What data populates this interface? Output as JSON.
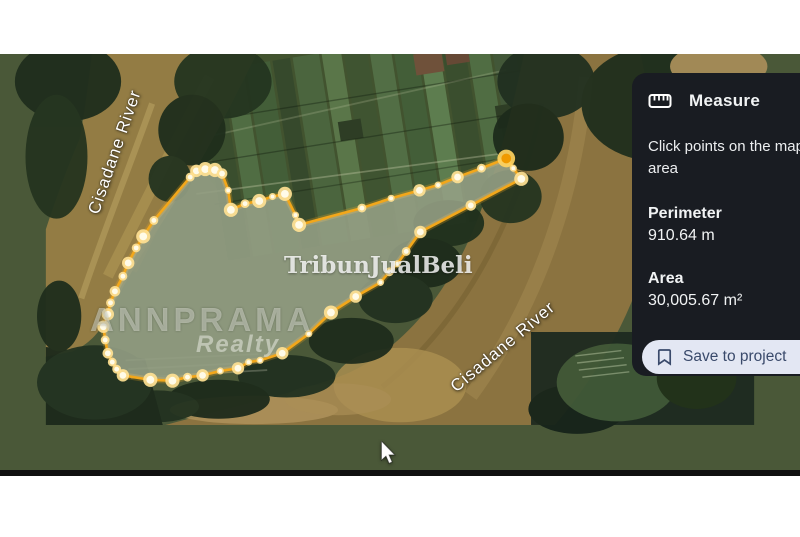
{
  "map": {
    "labels": [
      {
        "text": "Cisadane River"
      },
      {
        "text": "Cisadane River"
      }
    ],
    "watermarks": {
      "brand": "ANNPRAMA",
      "brand_sub": "Realty",
      "listing": "TribunJualBeli"
    }
  },
  "measurement": {
    "stroke_color": "#f2a71b",
    "fill_overlay": "rgba(255,255,255,0.30)",
    "meadow_color": "#5e6e46",
    "dot_halo": "#ffe193",
    "dot_core": "#fffbe8",
    "active_halo": "#ffd35e",
    "active_core": "#f09a00",
    "points": [
      {
        "x": 163,
        "y": 193,
        "r": 5
      },
      {
        "x": 170,
        "y": 186,
        "r": 7
      },
      {
        "x": 180,
        "y": 184,
        "r": 8
      },
      {
        "x": 191,
        "y": 185,
        "r": 8
      },
      {
        "x": 199,
        "y": 189,
        "r": 6
      },
      {
        "x": 206,
        "y": 208,
        "r": 4
      },
      {
        "x": 209,
        "y": 230,
        "r": 8
      },
      {
        "x": 225,
        "y": 223,
        "r": 5
      },
      {
        "x": 241,
        "y": 220,
        "r": 8
      },
      {
        "x": 256,
        "y": 215,
        "r": 4
      },
      {
        "x": 270,
        "y": 212,
        "r": 8
      },
      {
        "x": 282,
        "y": 236,
        "r": 4
      },
      {
        "x": 286,
        "y": 247,
        "r": 8
      },
      {
        "x": 357,
        "y": 228,
        "r": 5
      },
      {
        "x": 390,
        "y": 217,
        "r": 4
      },
      {
        "x": 422,
        "y": 208,
        "r": 7
      },
      {
        "x": 443,
        "y": 202,
        "r": 4
      },
      {
        "x": 465,
        "y": 193,
        "r": 7
      },
      {
        "x": 492,
        "y": 183,
        "r": 5
      },
      {
        "x": 520,
        "y": 172,
        "r": 10,
        "active": true
      },
      {
        "x": 528,
        "y": 183,
        "r": 4
      },
      {
        "x": 537,
        "y": 195,
        "r": 8
      },
      {
        "x": 480,
        "y": 225,
        "r": 6
      },
      {
        "x": 423,
        "y": 255,
        "r": 7
      },
      {
        "x": 407,
        "y": 277,
        "r": 5
      },
      {
        "x": 397,
        "y": 291,
        "r": 4
      },
      {
        "x": 388,
        "y": 300,
        "r": 5
      },
      {
        "x": 378,
        "y": 312,
        "r": 4
      },
      {
        "x": 350,
        "y": 328,
        "r": 7
      },
      {
        "x": 322,
        "y": 346,
        "r": 8
      },
      {
        "x": 297,
        "y": 370,
        "r": 4
      },
      {
        "x": 267,
        "y": 392,
        "r": 7
      },
      {
        "x": 242,
        "y": 400,
        "r": 4
      },
      {
        "x": 229,
        "y": 402,
        "r": 4
      },
      {
        "x": 217,
        "y": 409,
        "r": 7
      },
      {
        "x": 197,
        "y": 412,
        "r": 4
      },
      {
        "x": 177,
        "y": 417,
        "r": 7
      },
      {
        "x": 160,
        "y": 419,
        "r": 5
      },
      {
        "x": 143,
        "y": 423,
        "r": 8
      },
      {
        "x": 118,
        "y": 422,
        "r": 8
      },
      {
        "x": 87,
        "y": 417,
        "r": 7
      },
      {
        "x": 80,
        "y": 410,
        "r": 5
      },
      {
        "x": 75,
        "y": 402,
        "r": 5
      },
      {
        "x": 70,
        "y": 392,
        "r": 6
      },
      {
        "x": 67,
        "y": 377,
        "r": 5
      },
      {
        "x": 65,
        "y": 362,
        "r": 7
      },
      {
        "x": 70,
        "y": 348,
        "r": 7
      },
      {
        "x": 73,
        "y": 335,
        "r": 5
      },
      {
        "x": 78,
        "y": 322,
        "r": 6
      },
      {
        "x": 87,
        "y": 305,
        "r": 5
      },
      {
        "x": 93,
        "y": 290,
        "r": 7
      },
      {
        "x": 102,
        "y": 273,
        "r": 5
      },
      {
        "x": 110,
        "y": 260,
        "r": 8
      },
      {
        "x": 122,
        "y": 242,
        "r": 5
      }
    ]
  },
  "panel": {
    "bg": "#191c22",
    "title": "Measure",
    "instruction_line1": "Click points on the map",
    "instruction_line2": "area",
    "perimeter_label": "Perimeter",
    "perimeter_value": "910.64 m",
    "area_label": "Area",
    "area_value": "30,005.67 m²",
    "save_button_label": "Save to project",
    "button_bg": "#e3e7f3",
    "button_text_color": "#3a4a6b"
  }
}
